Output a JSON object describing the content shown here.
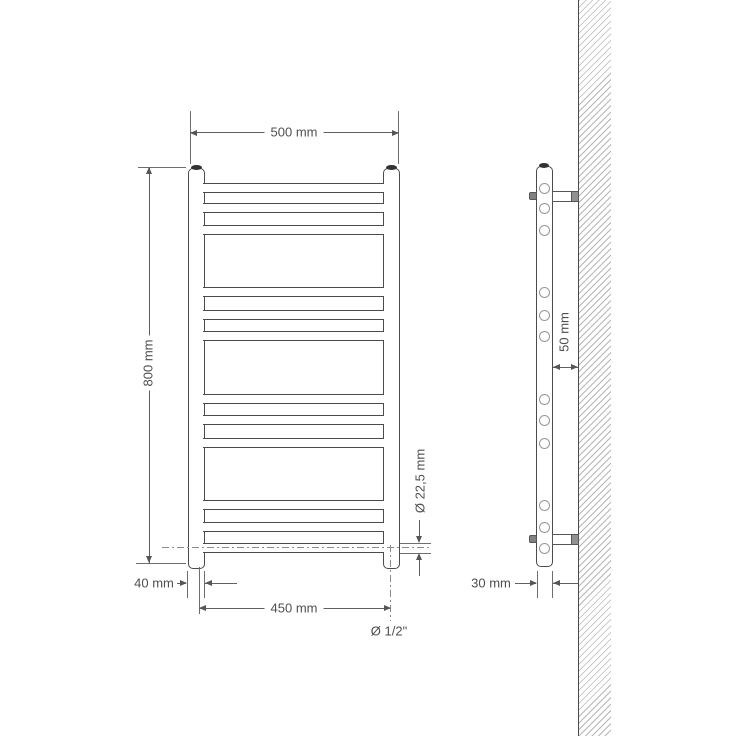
{
  "drawing_title": "",
  "front_view": {
    "labels": {
      "width": "500 mm",
      "height": "800 mm",
      "collector_width": "40 mm",
      "axis_distance": "450 mm",
      "connection": "Ø 1/2\"",
      "rung_diameter": "Ø 22,5 mm"
    },
    "rung_centers_y": [
      188,
      208,
      230,
      292,
      315,
      336,
      399,
      420,
      443,
      505,
      527,
      548
    ]
  },
  "side_view": {
    "labels": {
      "wall_distance": "50 mm",
      "depth": "30 mm"
    },
    "rung_centers_y": [
      188,
      208,
      230,
      292,
      315,
      336,
      399,
      420,
      443,
      505,
      527,
      548
    ],
    "bracket_centers_y": [
      196,
      539
    ]
  },
  "colors": {
    "line": "#4b4b4b",
    "dim_line": "#606060",
    "text": "#4f4f4f",
    "hatch": "#b6b6b6",
    "background": "#ffffff"
  }
}
